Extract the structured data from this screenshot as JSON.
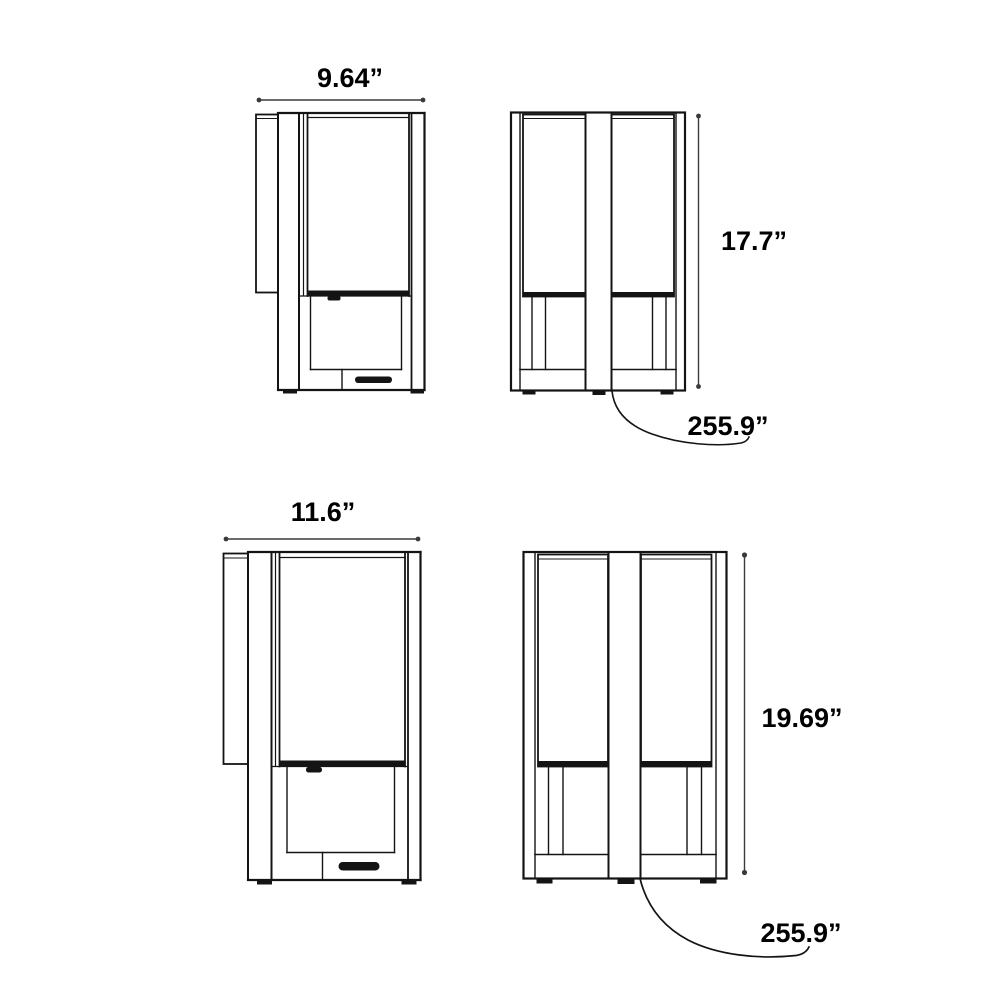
{
  "diagram": {
    "colors": {
      "background": "#ffffff",
      "line": "#141414",
      "dimension_line": "#3a3a3a",
      "text": "#000000"
    },
    "views": {
      "small_side": {
        "width": "9.64”"
      },
      "small_front": {
        "height": "17.7”",
        "cord_length": "255.9”"
      },
      "large_side": {
        "width": "11.6”"
      },
      "large_front": {
        "height": "19.69”",
        "cord_length": "255.9”"
      }
    }
  }
}
